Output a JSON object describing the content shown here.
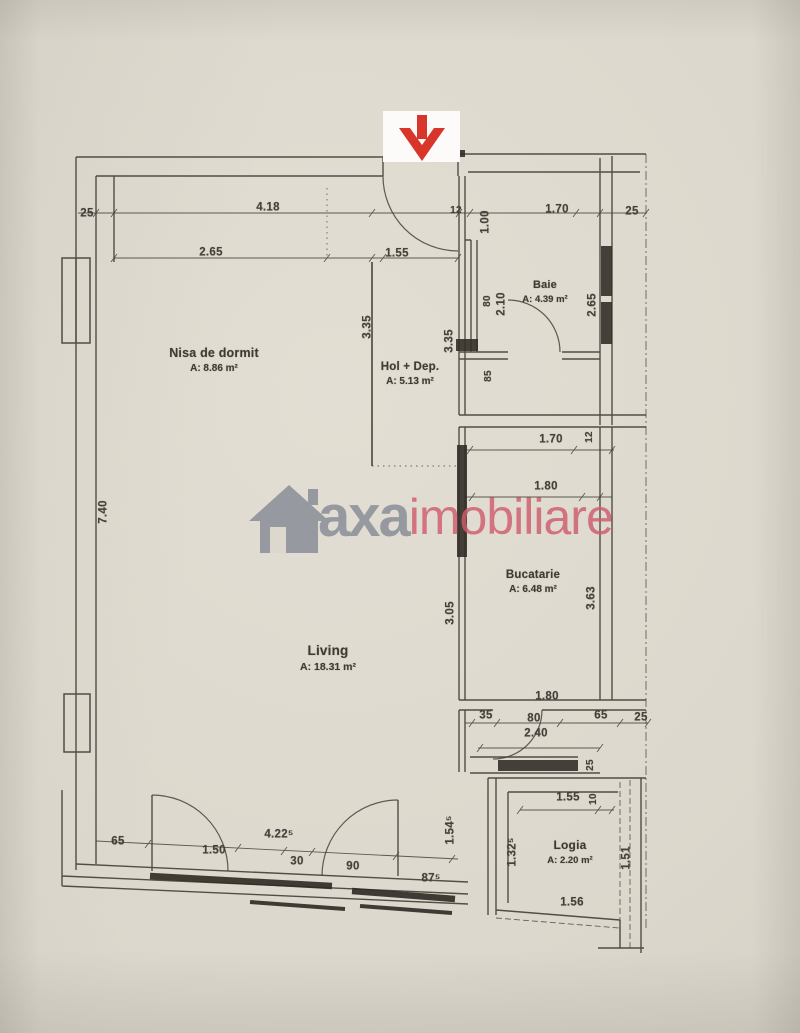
{
  "watermark": {
    "brand_gray": "axa",
    "brand_red": "imobiliare",
    "gray_color": "#868b96",
    "red_color": "#cf5d6e"
  },
  "entrance_marker": {
    "symbol": "down-arrow",
    "color": "#d8362b"
  },
  "rooms": [
    {
      "name": "Nisa de dormit",
      "area": "A: 8.86 m²"
    },
    {
      "name": "Hol + Dep.",
      "area": "A: 5.13 m²"
    },
    {
      "name": "Baie",
      "area": "A: 4.39 m²"
    },
    {
      "name": "Bucatarie",
      "area": "A: 6.48 m²"
    },
    {
      "name": "Living",
      "area": "A: 18.31 m²"
    },
    {
      "name": "Logia",
      "area": "A: 2.20 m²"
    }
  ],
  "dims": {
    "h": [
      {
        "t": "25"
      },
      {
        "t": "4.18"
      },
      {
        "t": "12"
      },
      {
        "t": "1.70"
      },
      {
        "t": "25"
      },
      {
        "t": "2.65"
      },
      {
        "t": "1.55"
      },
      {
        "t": "1.70"
      },
      {
        "t": "1.80"
      },
      {
        "t": "1.80"
      },
      {
        "t": "35"
      },
      {
        "t": "80"
      },
      {
        "t": "65"
      },
      {
        "t": "25"
      },
      {
        "t": "2.40"
      },
      {
        "t": "1.55"
      },
      {
        "t": "1.56"
      },
      {
        "t": "65"
      },
      {
        "t": "1.50"
      },
      {
        "t": "4.22⁵"
      },
      {
        "t": "30"
      },
      {
        "t": "90"
      },
      {
        "t": "87⁵"
      }
    ],
    "v": [
      {
        "t": "1.00"
      },
      {
        "t": "80"
      },
      {
        "t": "2.10"
      },
      {
        "t": "2.65"
      },
      {
        "t": "3.35"
      },
      {
        "t": "3.35"
      },
      {
        "t": "85"
      },
      {
        "t": "7.40"
      },
      {
        "t": "12"
      },
      {
        "t": "3.63"
      },
      {
        "t": "3.05"
      },
      {
        "t": "25"
      },
      {
        "t": "10"
      },
      {
        "t": "1.32⁵"
      },
      {
        "t": "1.54⁵"
      },
      {
        "t": "1.51"
      }
    ]
  }
}
